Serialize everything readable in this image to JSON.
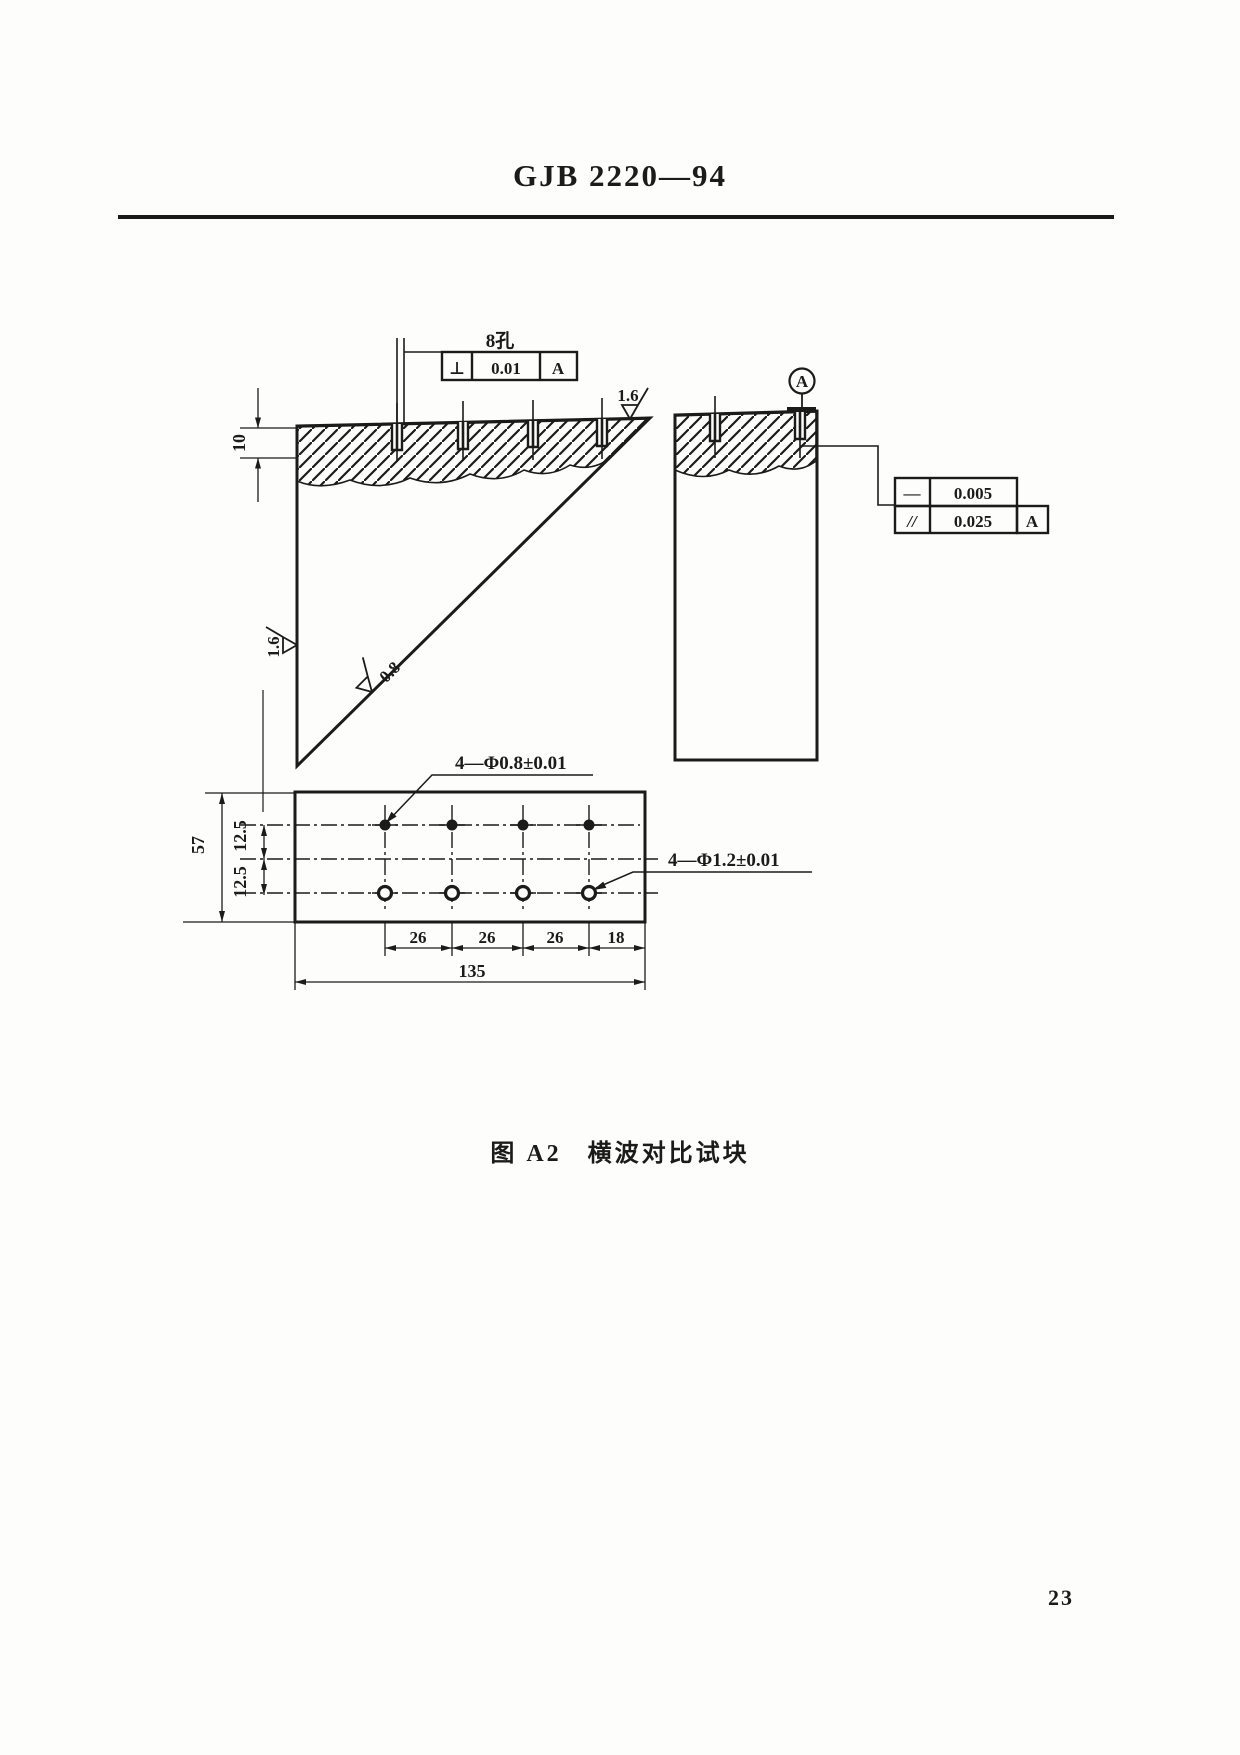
{
  "header": {
    "standard_code": "GJB 2220—94"
  },
  "drawing": {
    "callouts": {
      "holes_label": "8孔",
      "small_holes": "4—Φ0.8±0.01",
      "large_holes": "4—Φ1.2±0.01"
    },
    "fcf_perpendicularity": {
      "symbol": "⊥",
      "value": "0.01",
      "datum": "A"
    },
    "fcf_straightness": {
      "symbol": "—",
      "value": "0.005"
    },
    "fcf_parallelism": {
      "symbol": "//",
      "value": "0.025",
      "datum": "A"
    },
    "datum_label": "A",
    "roughness": {
      "left_edge": "1.6",
      "top_edge": "1.6",
      "hypotenuse": "0.8"
    },
    "dims": {
      "hole_depth": "10",
      "block_height": "57",
      "row_offset_upper": "12.5",
      "row_offset_lower": "12.5",
      "pitch_1": "26",
      "pitch_2": "26",
      "pitch_3": "26",
      "end_distance": "18",
      "block_length": "135"
    }
  },
  "caption": {
    "label": "图 A2",
    "title": "横波对比试块"
  },
  "page": {
    "number": "23"
  }
}
